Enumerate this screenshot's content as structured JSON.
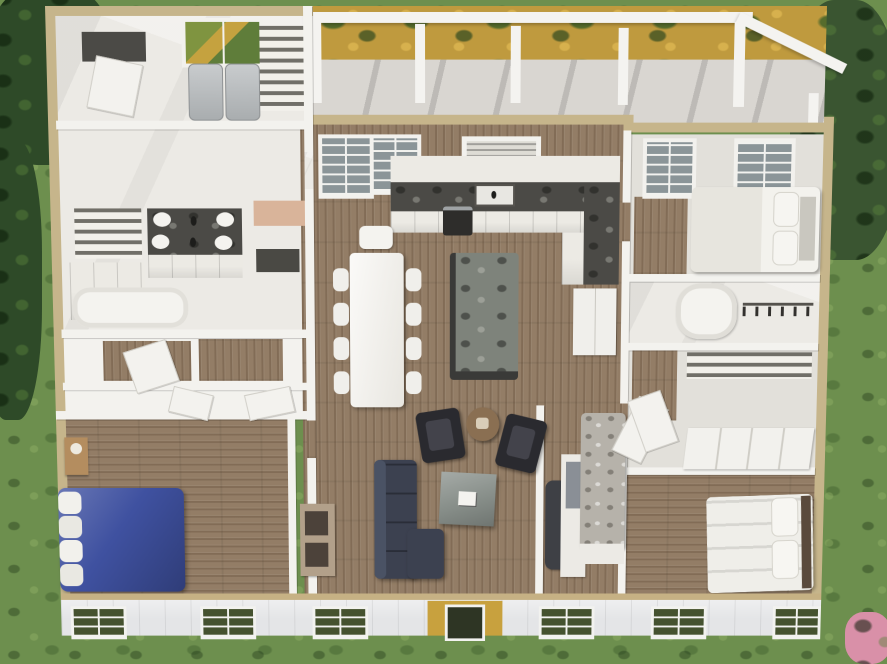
{
  "image": {
    "kind": "3D dollhouse floor-plan rendering",
    "description": "Overhead cutaway view of a furnished single-story house plan with rear pergola porch, lawn and shrubs around it"
  },
  "palette": {
    "grass": "#6d8f4e",
    "bush": "#2e4a28",
    "tree": "#3a5531",
    "flowers_pink": "#d990a8",
    "garden_ochre": "#bf9a3e",
    "deck": "#d9d6d1",
    "beam_white": "#f4f3f0",
    "wall_white": "#f3f2ee",
    "wall_tan": "#c6b58b",
    "marble_floor": "#eceae5",
    "light_floor": "#e2e0da",
    "wood": "#937d66",
    "counter_dark": "#4b4a46",
    "island_marble": "#7e837b",
    "cabinet_white": "#eceae4",
    "appliance_gray": "#b9bcbe",
    "bed_blue": "#3f51a0",
    "pillow_white": "#f2f1ec",
    "sofa_navy": "#3c4150",
    "chair_dark": "#2a2a2f",
    "coffee_table_gray": "#878e89",
    "side_table_brown": "#8a6f52",
    "console_tan": "#b2a08a",
    "bench_peach": "#d9b49a",
    "bed_gray": "#b6b2aa",
    "bed_white": "#efeee9",
    "headboard_brown": "#5a4a3c",
    "siding": "#e4e5e7",
    "sill_tan": "#c6b184",
    "window_green": "#45522f",
    "window_sky": "#8b9598",
    "tv_dark": "#1f2022",
    "range_dark": "#2e2d2b",
    "dark_base": "#3a3a38"
  },
  "rooms": {
    "lawn": "Surrounding lawn and shrubs",
    "porch": "Rear covered porch with pergola",
    "garden": "Flower bed behind porch",
    "laundry": "Laundry room",
    "bathroom": "Primary bathroom with double vanity",
    "closets": "Walk-in closets and hall",
    "bedroom_blue": "Bedroom with blue bed",
    "great_room": "Open great room",
    "kitchen": "Kitchen",
    "dining": "Dining area",
    "living": "Living area",
    "bedroom_top_right": "Guest bedroom (rear right)",
    "hall_bath": "Hall bathroom and closet",
    "closet_room": "Closet with sliding doors",
    "bedroom_mid": "Bedroom with gray bed",
    "bedroom_bottom_right": "Bedroom (front right)",
    "facade": "Front facade with siding and windows"
  },
  "furniture": {
    "washer": "Washer",
    "dryer": "Dryer",
    "laundry_window": "Laundry window",
    "laundry_counter": "Laundry counter",
    "laundry_shelves": "Laundry shelving",
    "closet_door": "Closet door",
    "vanity": "Double vanity with round sinks",
    "linen_shelves": "Linen shelves",
    "bath_cabinet": "Bathroom cabinet",
    "tub": "Bathtub",
    "bench": "Peach bench",
    "blue_bed": "Queen bed with blue duvet",
    "nightstand": "Nightstand with lamp",
    "kitchen_window": "Kitchen window",
    "sink_window": "Shuttered window over sink",
    "kitchen_counter": "L-shaped counter with dark top",
    "kitchen_sink": "Kitchen sink",
    "range": "Range",
    "fridge": "Refrigerator",
    "island": "Kitchen island with stone top",
    "dining_table": "Dining table",
    "dining_chair": "Dining chair",
    "sofa": "Navy sectional sofa",
    "coffee_table": "Square coffee table",
    "magazines": "Magazines on table",
    "armchair": "Dark armchair",
    "side_table": "Round side table",
    "console": "Media console",
    "tv": "Wall TV",
    "gray_bed": "Bed with gray textured duvet",
    "white_bed_rear": "Bed with white and patterned bedding",
    "white_bed_front": "Bed with white duvet",
    "sliding_doors": "Sliding closet doors",
    "closet_rod": "Closet rod with hangers",
    "shelf_band": "Closet shelving",
    "pergola_beam": "Pergola beam",
    "porch_post": "Porch post",
    "front_window": "Front window",
    "front_door": "Front door"
  }
}
